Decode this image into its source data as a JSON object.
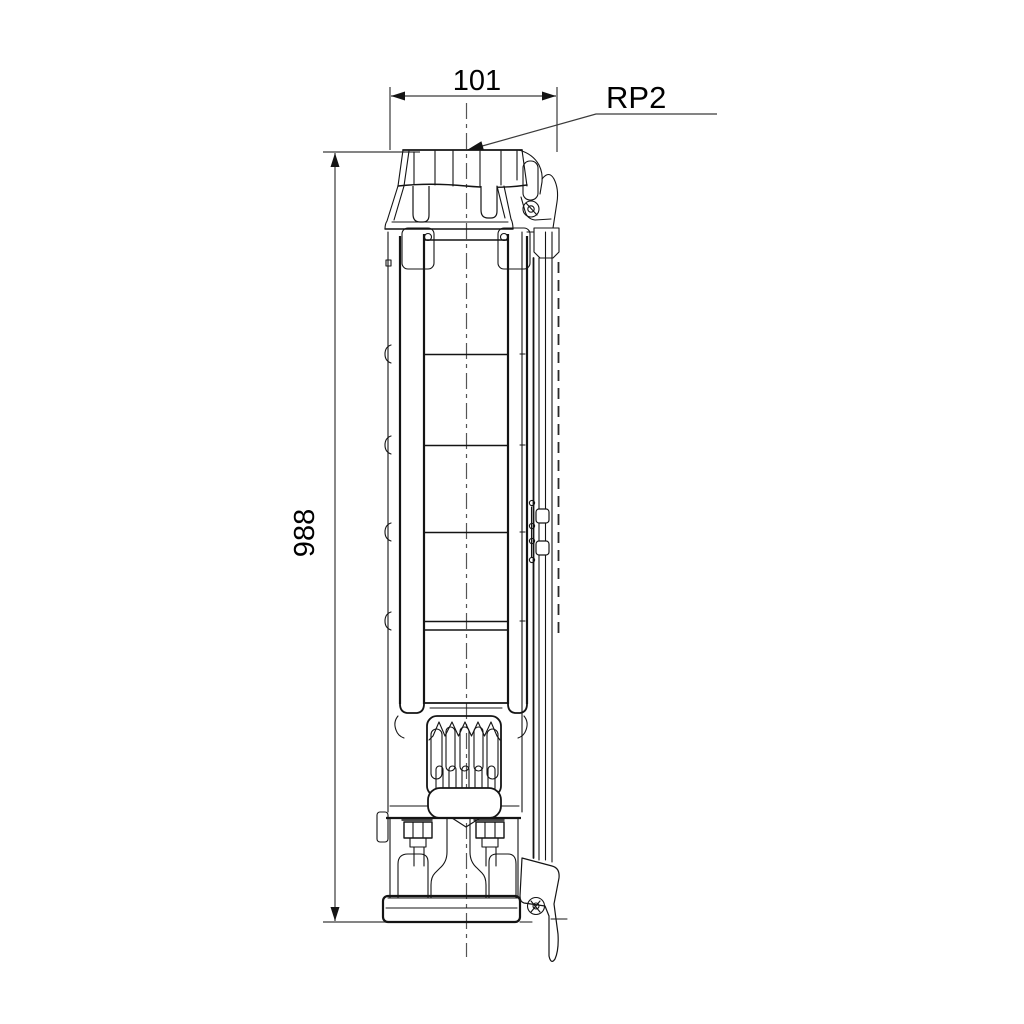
{
  "page": {
    "background": "#ffffff",
    "width": 1024,
    "height": 1024
  },
  "drawing": {
    "kind": "technical dimensional drawing - submersible borehole pump, side elevation",
    "line_color": "#141414",
    "centerline_color": "#555555",
    "dimensions": {
      "width": "101",
      "height": "988"
    },
    "labels": {
      "connection": "RP2"
    }
  }
}
